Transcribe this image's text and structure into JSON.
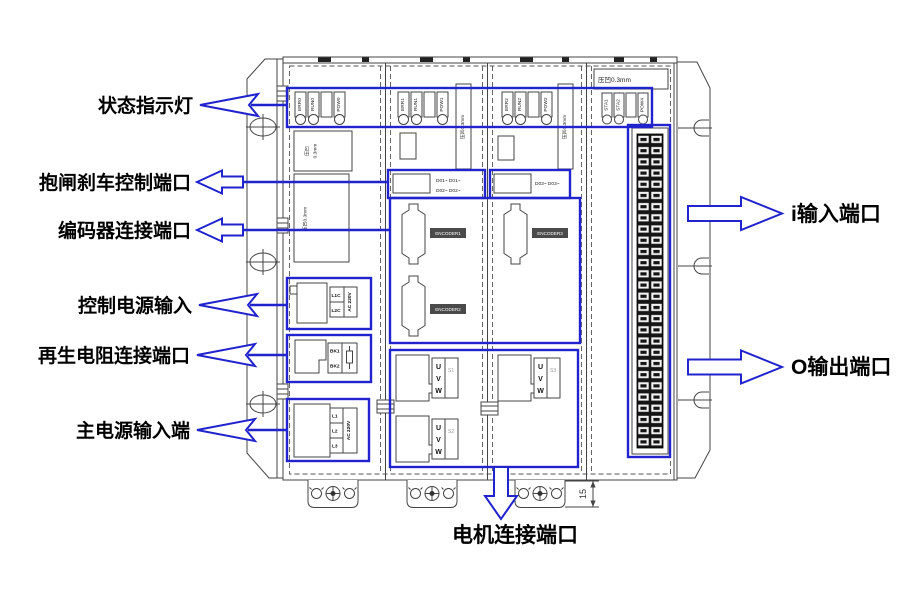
{
  "callouts": {
    "status_lights": "状态指示灯",
    "brake_port": "抱闸刹车控制端口",
    "encoder_port": "编码器连接端口",
    "control_power": "控制电源输入",
    "regen_port": "再生电阻连接端口",
    "main_power": "主电源输入端",
    "i_input_port": "i输入端口",
    "o_output_port": "O输出端口",
    "motor_port": "电机连接端口"
  },
  "device": {
    "emboss": {
      "full": "压凹0.3mm",
      "line1": "压凹",
      "line2": "0.3mm"
    },
    "modules": [
      {
        "leds": [
          "ERR0",
          "RUN0",
          "POW0"
        ]
      },
      {
        "leds": [
          "ERR1",
          "RUN1",
          "POW1"
        ]
      },
      {
        "leds": [
          "ERR2",
          "RUN2",
          "POW2"
        ]
      },
      {
        "leds": [
          "STA1",
          "STA2",
          "POW4"
        ]
      }
    ],
    "brake_labels": [
      "D01~ D01~",
      "D02~ D02~",
      "D03~ D03~"
    ],
    "encoder_labels": [
      "ENCODER1",
      "ENCODER2",
      "ENCODER3"
    ],
    "terminals": {
      "control": [
        "L1C",
        "L2C"
      ],
      "ac": "AC 220V",
      "regen": [
        "BK1",
        "BK2"
      ],
      "main": [
        "L1",
        "L2",
        "L3"
      ],
      "uvw": [
        "U",
        "V",
        "W"
      ],
      "motor_ids": [
        "S1",
        "S2",
        "S3"
      ]
    },
    "dimension": "15"
  },
  "colors": {
    "accent": "#2123cd",
    "line": "#444444"
  }
}
